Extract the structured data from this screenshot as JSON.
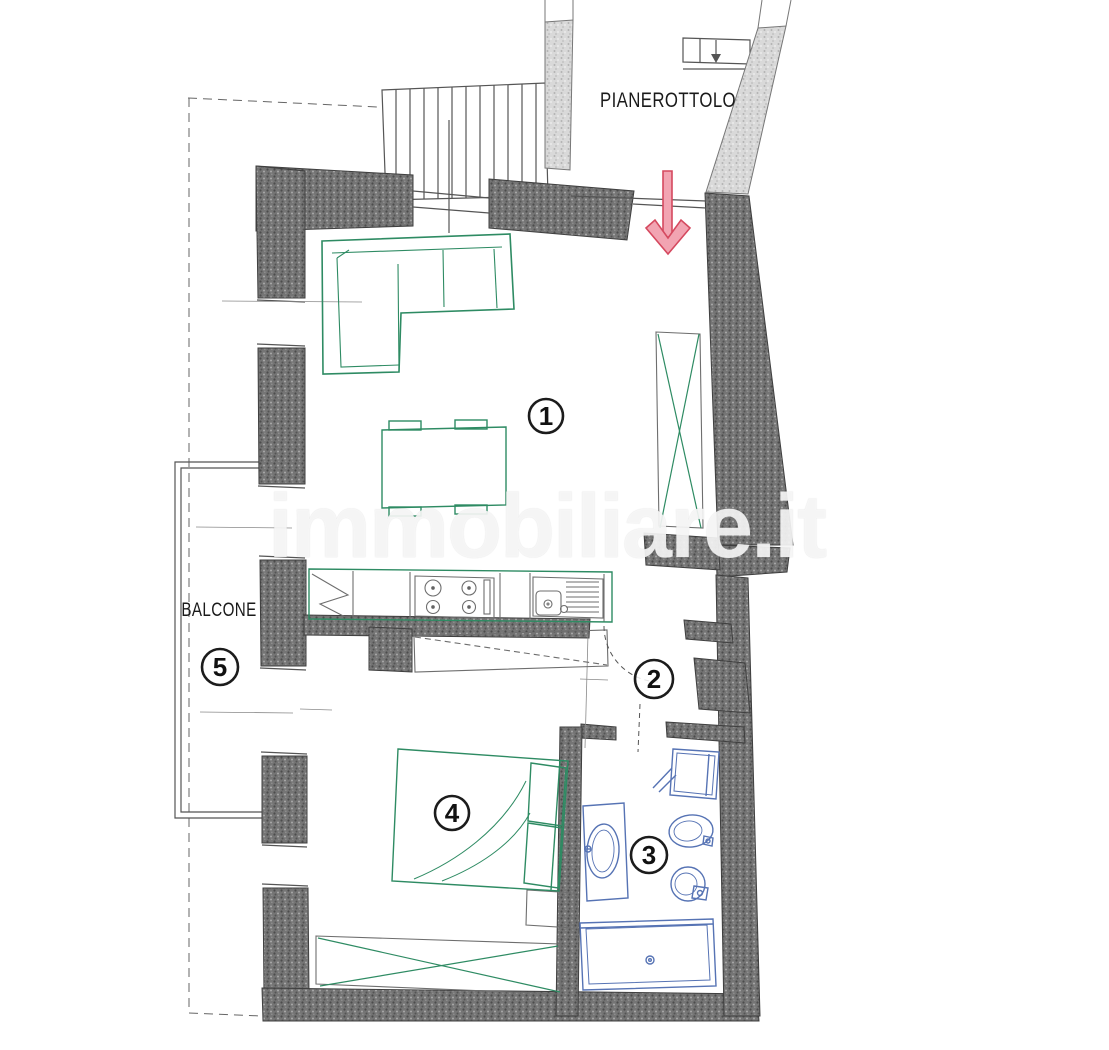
{
  "plan": {
    "watermark_text": "immobiliare.it",
    "labels": {
      "landing": "PIANEROTTOLO",
      "balcony": "BALCONE"
    },
    "rooms": [
      {
        "number": "1"
      },
      {
        "number": "2"
      },
      {
        "number": "3"
      },
      {
        "number": "4"
      },
      {
        "number": "5"
      }
    ],
    "colors": {
      "furniture": "#2e8b63",
      "fixtures": "#5673b4",
      "arrow_fill": "#f2a4b2",
      "arrow_stroke": "#d5495f",
      "wall_dark_base": "#757575",
      "wall_light_base": "#d9d9d9",
      "watermark": "rgba(250,250,250,0.86)"
    }
  }
}
